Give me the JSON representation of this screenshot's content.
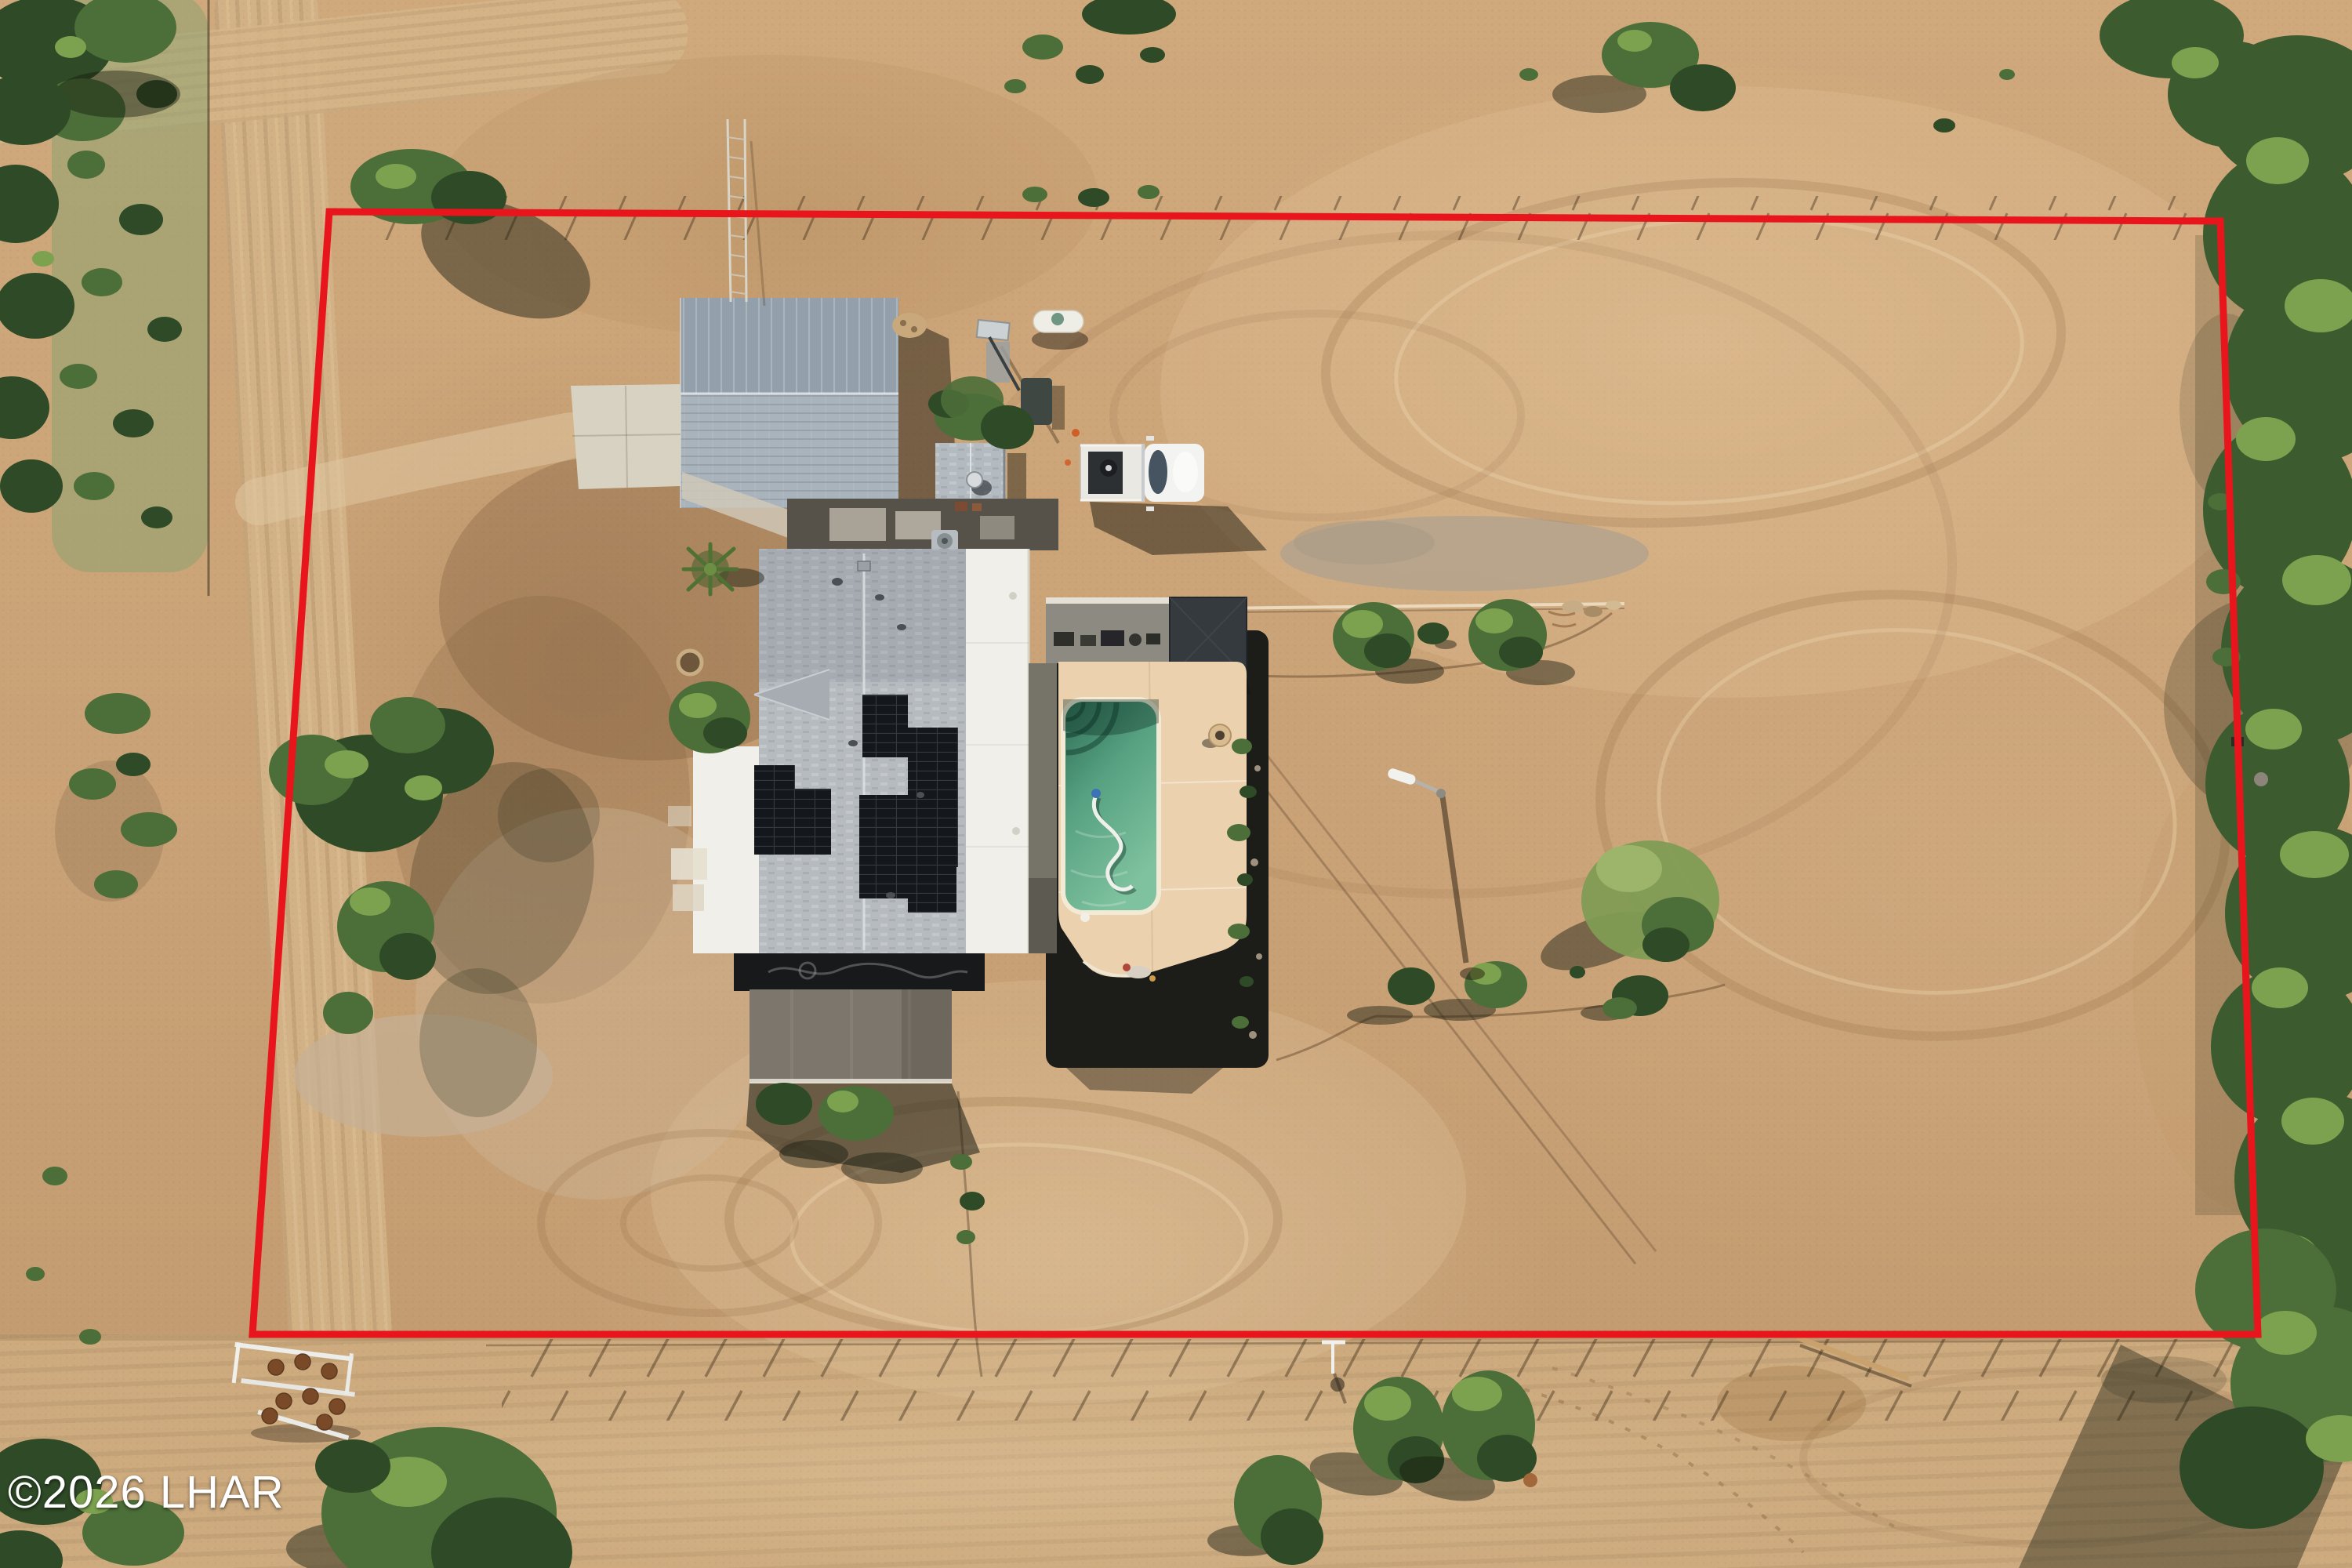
{
  "image": {
    "kind": "aerial-drone-photograph",
    "description": "Overhead aerial view of a fenced desert property outlined in red, containing a main house with rooftop solar panels, a detached metal garage with concrete driveway, a storage shed, a fenced swimming pool with tan deck and shade pergola, a white utility truck, a propane tank, a graded dirt arena with tire tracks, desert trees and scrub, dirt roads on the west and south, and dense trees along the east side."
  },
  "watermark": {
    "text": "©2026 LHAR"
  },
  "palette": {
    "boundary_red": "#e8161c",
    "dirt_base": "#c8a277",
    "road_tan": "#d2b286",
    "tree_dark": "#2e4a26",
    "tree_mid": "#4c6e38",
    "tree_light": "#7ca24f",
    "forest_green": "#3c5c30",
    "garage_top": "#93a0ab",
    "garage_bottom": "#a9b3bc",
    "shingle_gray": "#b6bbc0",
    "flat_white": "#f1efe9",
    "solar_black": "#14171b",
    "patio_taupe": "#7d766c",
    "concrete": "#d8d2c3",
    "deck_tan": "#ecd1af",
    "pool_green": "#56a181",
    "pergola_gray": "#343a3e",
    "truck_white": "#f3f4f2"
  },
  "features": [
    "red-property-boundary",
    "main-house-with-solar-panels",
    "detached-garage-workshop",
    "storage-shed",
    "swimming-pool",
    "pool-deck",
    "shade-pergola",
    "covered-patio",
    "white-utility-truck",
    "propane-tank",
    "concrete-driveway",
    "antenna-tower",
    "light-pole",
    "dirt-arena-with-tire-tracks",
    "dirt-roads",
    "desert-trees-and-scrub",
    "horse-obstacles",
    "photo-watermark"
  ]
}
